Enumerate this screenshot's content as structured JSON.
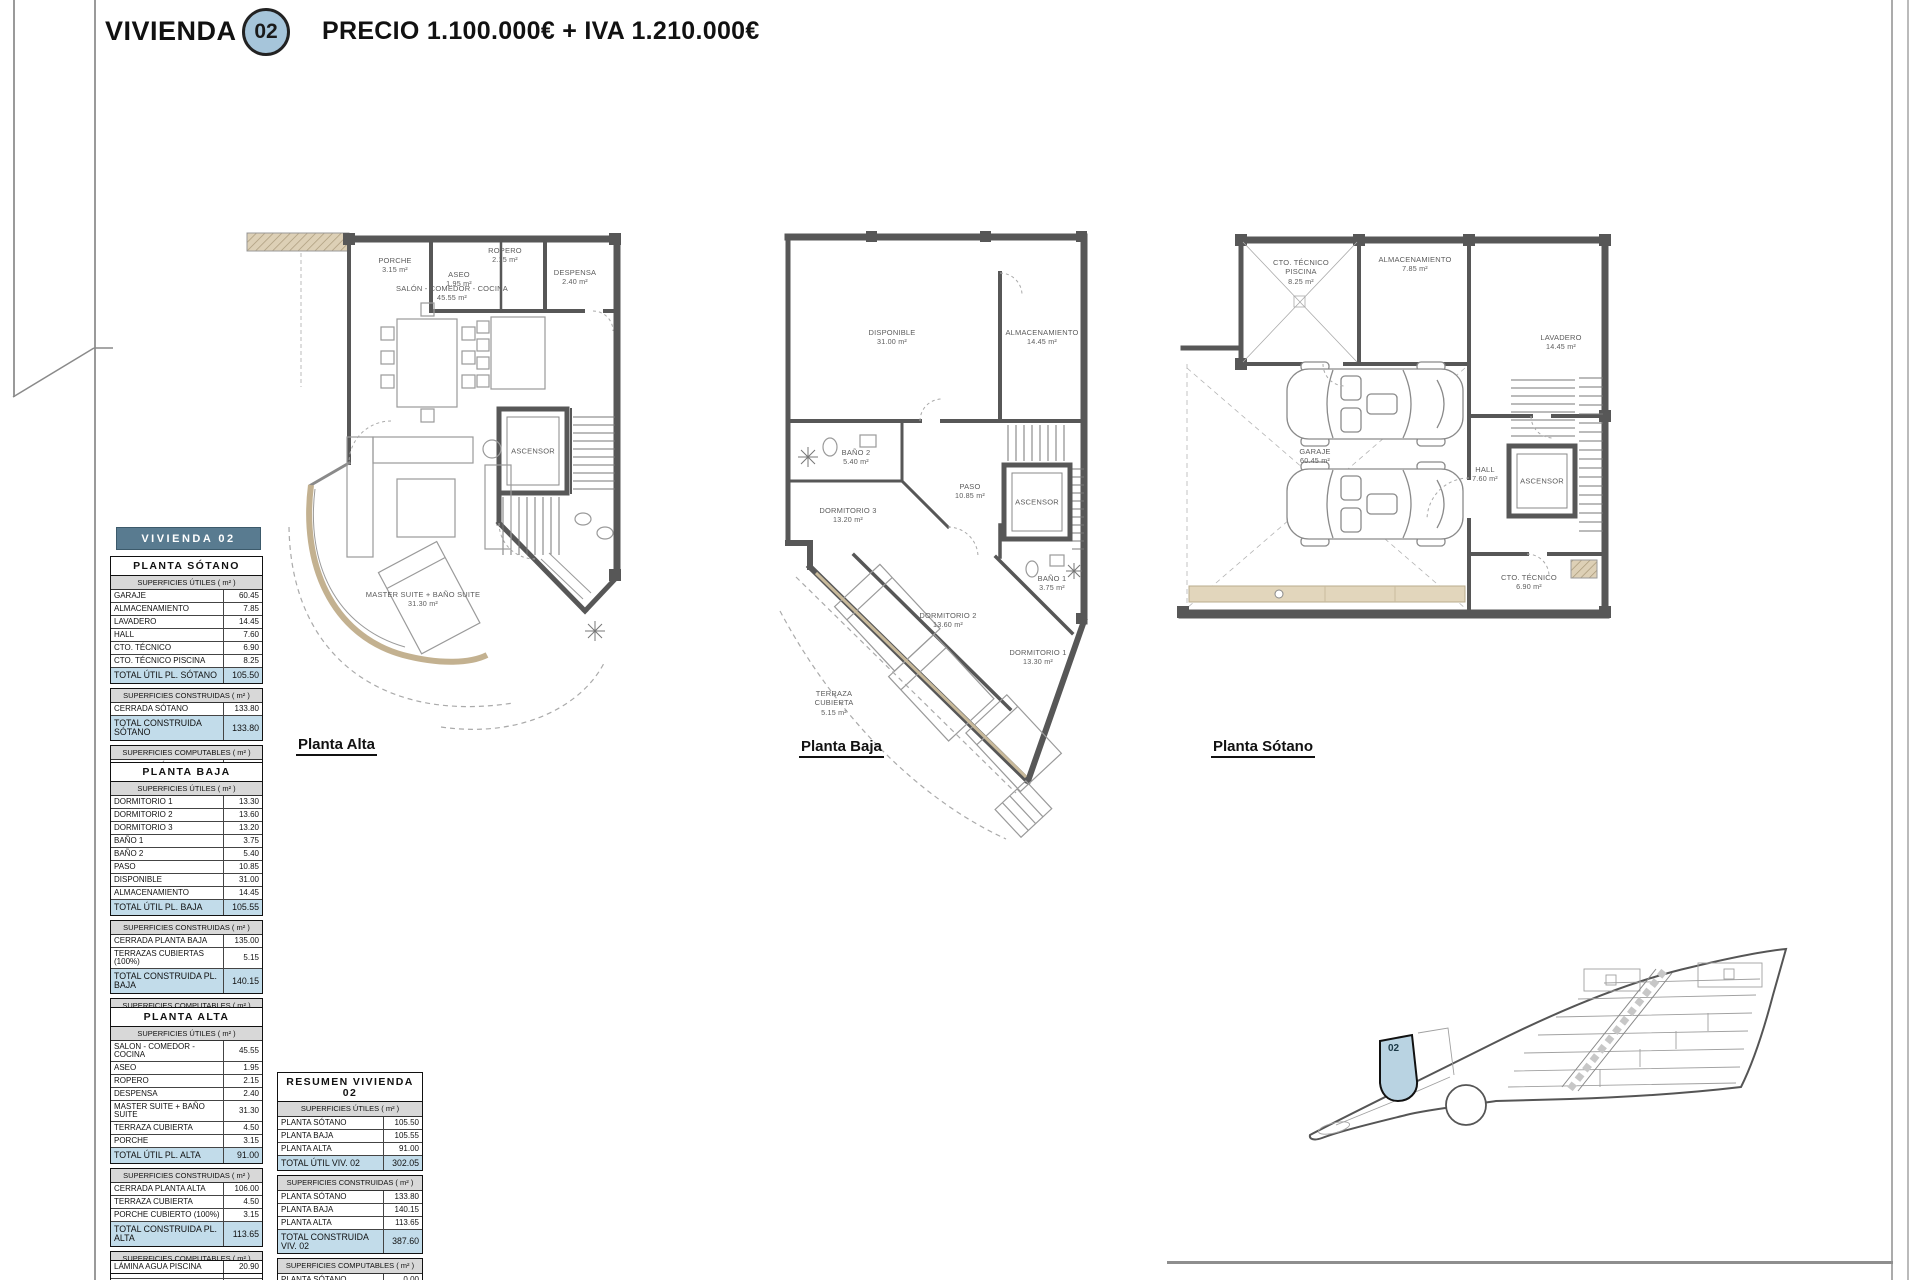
{
  "header": {
    "title": "VIVIENDA",
    "unit": "02",
    "price_line": "PRECIO 1.100.000€ + IVA 1.210.000€"
  },
  "band": {
    "title": "VIVIENDA 02"
  },
  "colors": {
    "accent_band": "#597b90",
    "total_row": "#c2dcea",
    "section_header": "#d8d8d8",
    "unit_highlight": "#b9d3e2",
    "wall": "#575757",
    "tan": "#c9ba9b"
  },
  "tables": [
    {
      "title": "PLANTA SÓTANO",
      "sections": [
        {
          "header": "SUPERFICIES ÚTILES ( m² )",
          "rows": [
            [
              "GARAJE",
              "60.45"
            ],
            [
              "ALMACENAMIENTO",
              "7.85"
            ],
            [
              "LAVADERO",
              "14.45"
            ],
            [
              "HALL",
              "7.60"
            ],
            [
              "CTO. TÉCNICO",
              "6.90"
            ],
            [
              "CTO. TÉCNICO PISCINA",
              "8.25"
            ]
          ],
          "total": [
            "TOTAL ÚTIL PL. SÓTANO",
            "105.50"
          ]
        },
        {
          "header": "SUPERFICIES CONSTRUIDAS ( m² )",
          "rows": [
            [
              "CERRADA SÓTANO",
              "133.80"
            ]
          ],
          "total": [
            "TOTAL CONSTRUIDA SÓTANO",
            "133.80"
          ]
        },
        {
          "header": "SUPERFICIES COMPUTABLES ( m² )",
          "rows": [
            [
              "CERRADA SÓTANO (-25 SÓTANO)",
              "0.00"
            ]
          ],
          "total": [
            "TOTAL COMPUTABLE SÓTANO",
            "0.00"
          ]
        }
      ]
    },
    {
      "title": "PLANTA BAJA",
      "sections": [
        {
          "header": "SUPERFICIES ÚTILES ( m² )",
          "rows": [
            [
              "DORMITORIO 1",
              "13.30"
            ],
            [
              "DORMITORIO 2",
              "13.60"
            ],
            [
              "DORMITORIO 3",
              "13.20"
            ],
            [
              "BAÑO 1",
              "3.75"
            ],
            [
              "BAÑO 2",
              "5.40"
            ],
            [
              "PASO",
              "10.85"
            ],
            [
              "DISPONIBLE",
              "31.00"
            ],
            [
              "ALMACENAMIENTO",
              "14.45"
            ]
          ],
          "total": [
            "TOTAL ÚTIL PL. BAJA",
            "105.55"
          ]
        },
        {
          "header": "SUPERFICIES CONSTRUIDAS ( m² )",
          "rows": [
            [
              "CERRADA PLANTA BAJA",
              "135.00"
            ],
            [
              "TERRAZAS CUBIERTAS (100%)",
              "5.15"
            ]
          ],
          "total": [
            "TOTAL CONSTRUIDA PL. BAJA",
            "140.15"
          ]
        },
        {
          "header": "SUPERFICIES COMPUTABLES ( m² )",
          "rows": [
            [
              "CERRADA PLANTA BAJA",
              "33.95"
            ],
            [
              "TERRAZAS CUBIERTAS (100%)",
              "5.15"
            ]
          ],
          "total": [
            "TOTAL COMPUTABLE PL. BAJA",
            "39.10"
          ]
        }
      ]
    },
    {
      "title": "PLANTA ALTA",
      "sections": [
        {
          "header": "SUPERFICIES ÚTILES ( m² )",
          "rows": [
            [
              "SALON - COMEDOR - COCINA",
              "45.55"
            ],
            [
              "ASEO",
              "1.95"
            ],
            [
              "ROPERO",
              "2.15"
            ],
            [
              "DESPENSA",
              "2.40"
            ],
            [
              "MASTER SUITE + BAÑO SUITE",
              "31.30"
            ],
            [
              "TERRAZA CUBIERTA",
              "4.50"
            ],
            [
              "PORCHE",
              "3.15"
            ]
          ],
          "total": [
            "TOTAL ÚTIL PL. ALTA",
            "91.00"
          ]
        },
        {
          "header": "SUPERFICIES CONSTRUIDAS ( m² )",
          "rows": [
            [
              "CERRADA PLANTA ALTA",
              "106.00"
            ],
            [
              "TERRAZA CUBIERTA",
              "4.50"
            ],
            [
              "PORCHE CUBIERTO (100%)",
              "3.15"
            ]
          ],
          "total": [
            "TOTAL CONSTRUIDA PL. ALTA",
            "113.65"
          ]
        },
        {
          "header": "SUPERFICIES COMPUTABLES ( m² )",
          "rows": [
            [
              "CERRADA PLANTA ALTA",
              "98.65"
            ],
            [
              "TERRAZA CUBIERTA",
              "4.50"
            ],
            [
              "PORCHE CUBIERTO",
              "3.15"
            ]
          ],
          "total": [
            "TOTAL COMPUTABLE PL. ALTA",
            "106.30"
          ]
        }
      ]
    },
    {
      "title": "RESUMEN VIVIENDA 02",
      "sections": [
        {
          "header": "SUPERFICIES ÚTILES ( m² )",
          "rows": [
            [
              "PLANTA SÓTANO",
              "105.50"
            ],
            [
              "PLANTA BAJA",
              "105.55"
            ],
            [
              "PLANTA ALTA",
              "91.00"
            ]
          ],
          "total": [
            "TOTAL ÚTIL VIV. 02",
            "302.05"
          ]
        },
        {
          "header": "SUPERFICIES CONSTRUIDAS ( m² )",
          "rows": [
            [
              "PLANTA SÓTANO",
              "133.80"
            ],
            [
              "PLANTA BAJA",
              "140.15"
            ],
            [
              "PLANTA ALTA",
              "113.65"
            ]
          ],
          "total": [
            "TOTAL CONSTRUIDA VIV. 02",
            "387.60"
          ]
        },
        {
          "header": "SUPERFICIES COMPUTABLES ( m² )",
          "rows": [
            [
              "PLANTA SÓTANO",
              "0.00"
            ],
            [
              "PLANTA BAJA",
              "39.10"
            ],
            [
              "PLANTA ALTA",
              "106.30"
            ]
          ],
          "total": [
            "TOTAL COMPUTABLE VIV. 02",
            "145.40"
          ]
        }
      ]
    }
  ],
  "extra_row": {
    "label": "LÁMINA AGUA PISCINA",
    "value": "20.90"
  },
  "plans": [
    {
      "name": "Planta Alta",
      "labels": [
        {
          "text": "PORCHE",
          "area": "3.15 m²",
          "x": 150,
          "y": 38
        },
        {
          "text": "ASEO",
          "area": "1.95 m²",
          "x": 214,
          "y": 52
        },
        {
          "text": "ROPERO",
          "area": "2.15 m²",
          "x": 260,
          "y": 28
        },
        {
          "text": "DESPENSA",
          "area": "2.40 m²",
          "x": 330,
          "y": 50
        },
        {
          "text": "SALÓN - COMEDOR - COCINA",
          "area": "45.55 m²",
          "x": 207,
          "y": 66
        },
        {
          "text": "ASCENSOR",
          "area": "",
          "x": 288,
          "y": 224
        },
        {
          "text": "MASTER SUITE + BAÑO SUITE",
          "area": "31.30 m²",
          "x": 178,
          "y": 372
        }
      ]
    },
    {
      "name": "Planta Baja",
      "labels": [
        {
          "text": "DISPONIBLE",
          "area": "31.00 m²",
          "x": 122,
          "y": 112
        },
        {
          "text": "ALMACENAMIENTO",
          "area": "14.45 m²",
          "x": 272,
          "y": 112
        },
        {
          "text": "BAÑO 2",
          "area": "5.40 m²",
          "x": 86,
          "y": 232
        },
        {
          "text": "PASO",
          "area": "10.85 m²",
          "x": 200,
          "y": 266
        },
        {
          "text": "ASCENSOR",
          "area": "",
          "x": 267,
          "y": 277
        },
        {
          "text": "DORMITORIO 3",
          "area": "13.20 m²",
          "x": 78,
          "y": 290
        },
        {
          "text": "DORMITORIO 2",
          "area": "13.60 m²",
          "x": 178,
          "y": 395
        },
        {
          "text": "BAÑO 1",
          "area": "3.75 m²",
          "x": 282,
          "y": 358
        },
        {
          "text": "DORMITORIO 1",
          "area": "13.30 m²",
          "x": 268,
          "y": 432
        },
        {
          "text": "TERRAZA CUBIERTA",
          "area": "5.15 m²",
          "x": 64,
          "y": 478,
          "w": 48
        },
        {
          "text": "",
          "area": "",
          "x": 0,
          "y": 0
        }
      ]
    },
    {
      "name": "Planta Sótano",
      "labels": [
        {
          "text": "CTO. TÉCNICO PISCINA",
          "area": "8.25 m²",
          "x": 126,
          "y": 44,
          "w": 56
        },
        {
          "text": "ALMACENAMIENTO",
          "area": "7.85 m²",
          "x": 240,
          "y": 36
        },
        {
          "text": "LAVADERO",
          "area": "14.45 m²",
          "x": 386,
          "y": 114
        },
        {
          "text": "GARAJE",
          "area": "60.45 m²",
          "x": 140,
          "y": 228
        },
        {
          "text": "HALL",
          "area": "7.60 m²",
          "x": 310,
          "y": 246
        },
        {
          "text": "ASCENSOR",
          "area": "",
          "x": 367,
          "y": 253
        },
        {
          "text": "CTO. TÉCNICO",
          "area": "6.90 m²",
          "x": 354,
          "y": 354
        }
      ]
    }
  ],
  "site": {
    "unit_label": "02"
  }
}
